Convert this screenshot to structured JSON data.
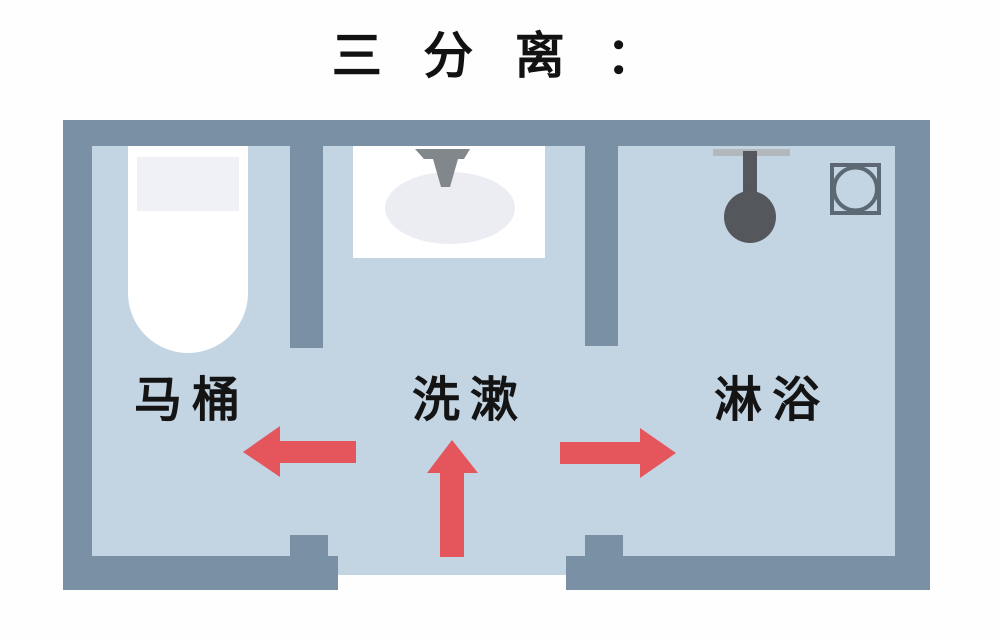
{
  "title": "三 分 离 ：",
  "rooms": [
    {
      "label": "马桶"
    },
    {
      "label": "洗漱"
    },
    {
      "label": "淋浴"
    }
  ],
  "fixtures": {
    "toilet": "toilet-top-view",
    "washing": "sink-with-faucet",
    "shower": "shower-head",
    "drain": "floor-drain"
  },
  "arrows": [
    {
      "icon": "arrow-left-icon",
      "direction": "left"
    },
    {
      "icon": "arrow-up-icon",
      "direction": "up"
    },
    {
      "icon": "arrow-right-icon",
      "direction": "right"
    }
  ],
  "colors": {
    "wall": "#7a90a4",
    "floor": "#c3d4e3",
    "arrow": "#e4555c",
    "fixture_white": "#ffffff",
    "fixture_dark": "#54575b",
    "faucet": "#82878c",
    "drain": "#5c6873",
    "text": "#141414",
    "background": "#fefefe"
  }
}
